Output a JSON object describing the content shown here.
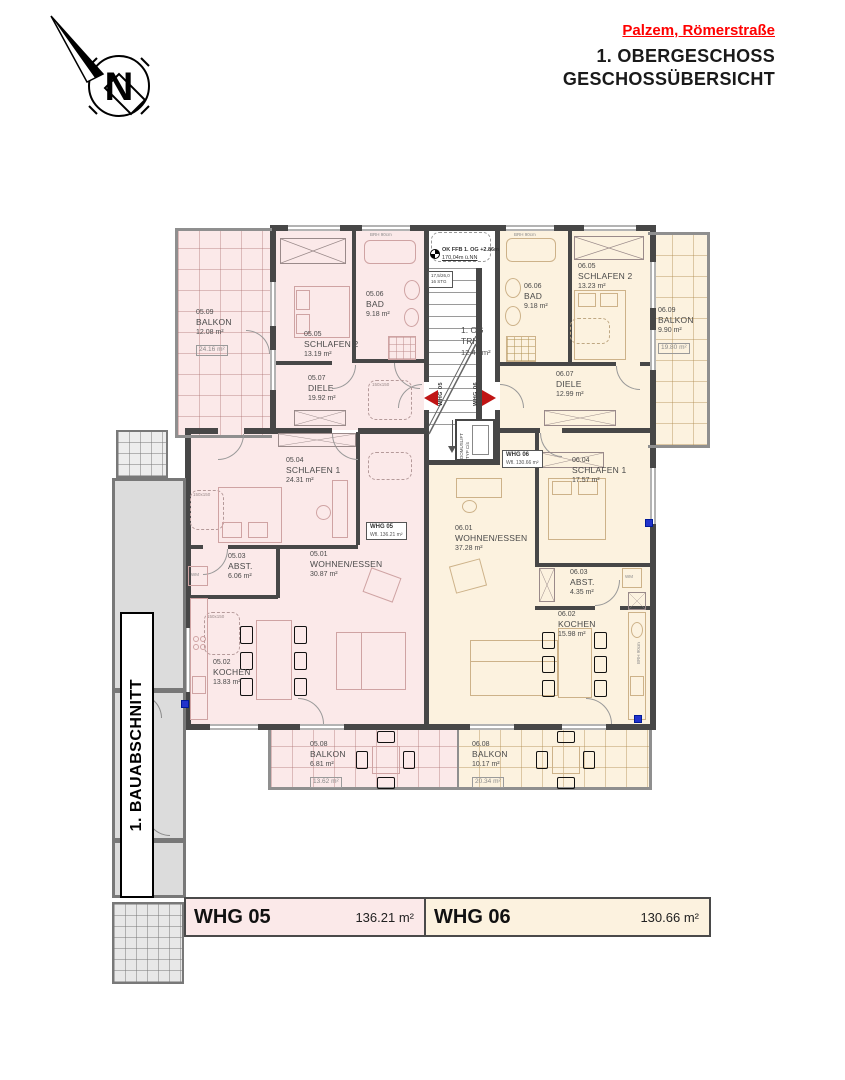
{
  "header": {
    "location": "Palzem, Römerstraße",
    "floor_title": "1. OBERGESCHOSS",
    "subtitle": "GESCHOSSÜBERSICHT"
  },
  "north": {
    "letter": "N"
  },
  "construction_phase_label": "1. BAUABSCHNITT",
  "core": {
    "stair_room": {
      "level": "1. OG",
      "name": "TRH.",
      "area": "12.41 m²"
    },
    "level_marks": {
      "ffb": "OK FFB 1. OG +2.86m",
      "nn": "170,04m ü.NN"
    },
    "stair_spec": {
      "line1": "17,5/26,0",
      "line2": "16 STG"
    },
    "elevator_line1": "DOMUSLIFT",
    "elevator_line2": "TYP C/4"
  },
  "entry_markers": {
    "whg05": "WHG 05",
    "whg06": "WHG 06"
  },
  "annotations": {
    "brh90": "BRH 90cm",
    "wm": "WM",
    "dim150": "150x150"
  },
  "apartments": {
    "whg05": {
      "label_box": {
        "line1": "WHG 05",
        "line2": "Wfl. 136.21 m²"
      },
      "rooms": {
        "wohnen": {
          "number": "05.01",
          "name": "WOHNEN/ESSEN",
          "area": "30.87 m²"
        },
        "kochen": {
          "number": "05.02",
          "name": "KOCHEN",
          "area": "13.83 m²"
        },
        "abst": {
          "number": "05.03",
          "name": "ABST.",
          "area": "6.06 m²"
        },
        "schlafen1": {
          "number": "05.04",
          "name": "SCHLAFEN 1",
          "area": "24.31 m²"
        },
        "schlafen2": {
          "number": "05.05",
          "name": "SCHLAFEN 2",
          "area": "13.19 m²"
        },
        "bad": {
          "number": "05.06",
          "name": "BAD",
          "area": "9.18 m²"
        },
        "diele": {
          "number": "05.07",
          "name": "DIELE",
          "area": "19.92 m²"
        },
        "balkon_sued": {
          "number": "05.08",
          "name": "BALKON",
          "area": "6.81 m²",
          "area_full": "13.62 m²"
        },
        "balkon_west": {
          "number": "05.09",
          "name": "BALKON",
          "area": "12.08 m²",
          "area_full": "24.16 m²"
        }
      }
    },
    "whg06": {
      "label_box": {
        "line1": "WHG 06",
        "line2": "Wfl. 130.66 m²"
      },
      "rooms": {
        "wohnen": {
          "number": "06.01",
          "name": "WOHNEN/ESSEN",
          "area": "37.28 m²"
        },
        "kochen": {
          "number": "06.02",
          "name": "KOCHEN",
          "area": "15.98 m²"
        },
        "abst": {
          "number": "06.03",
          "name": "ABST.",
          "area": "4.35 m²"
        },
        "schlafen1": {
          "number": "06.04",
          "name": "SCHLAFEN 1",
          "area": "17.57 m²"
        },
        "schlafen2": {
          "number": "06.05",
          "name": "SCHLAFEN 2",
          "area": "13.23 m²"
        },
        "bad": {
          "number": "06.06",
          "name": "BAD",
          "area": "9.18 m²"
        },
        "diele": {
          "number": "06.07",
          "name": "DIELE",
          "area": "12.99 m²"
        },
        "balkon_sued": {
          "number": "06.08",
          "name": "BALKON",
          "area": "10.17 m²",
          "area_full": "20.34 m²"
        },
        "balkon_ost": {
          "number": "06.09",
          "name": "BALKON",
          "area": "9.90 m²",
          "area_full": "19.80 m²"
        }
      }
    }
  },
  "legend": {
    "whg05": {
      "name": "WHG 05",
      "area": "136.21 m²"
    },
    "whg06": {
      "name": "WHG 06",
      "area": "130.66 m²"
    }
  },
  "colors": {
    "whg05_fill": "#fbe9e9",
    "whg06_fill": "#fcf2df",
    "accent_red": "#ff0000",
    "marker_red": "#c01414"
  }
}
